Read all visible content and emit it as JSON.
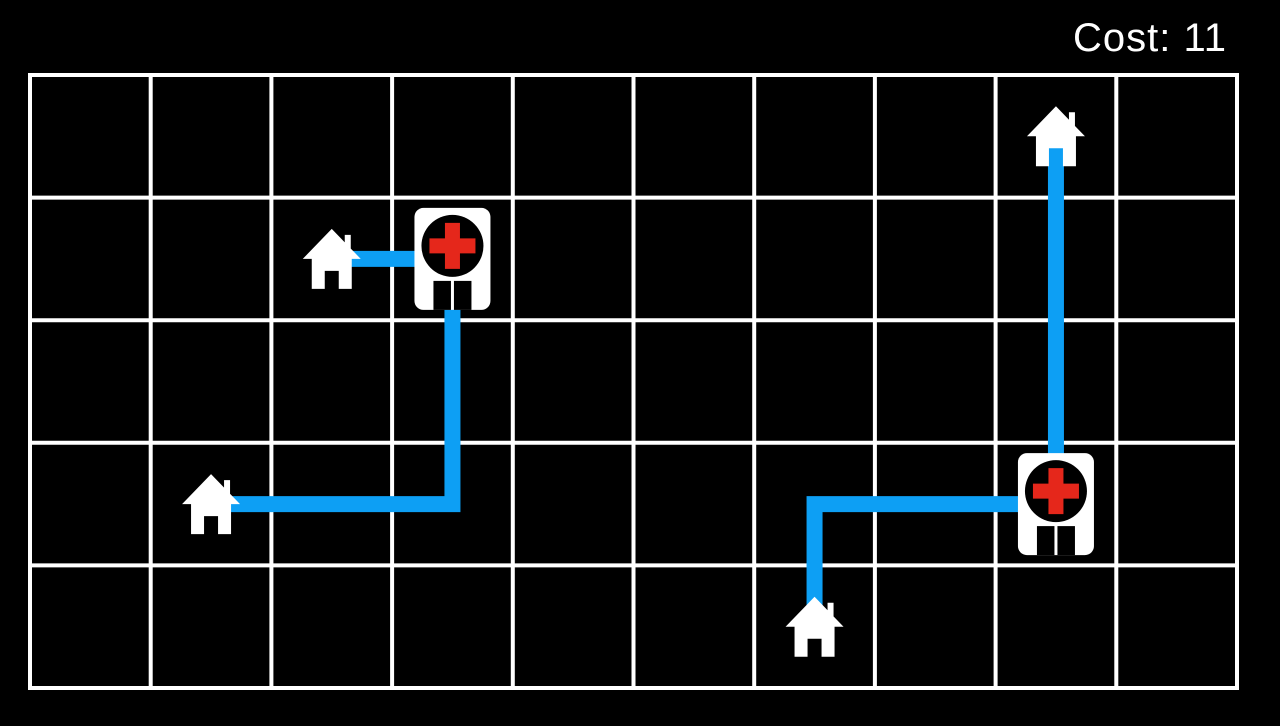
{
  "hud": {
    "cost_label": "Cost: 11",
    "cost_value": 11
  },
  "board": {
    "grid": {
      "columns": 10,
      "rows": 5,
      "left": 30,
      "top": 75,
      "cell_width": 120.7,
      "cell_height": 122.6,
      "line_thickness": 4
    },
    "entities": [
      {
        "id": "house-1",
        "type": "house",
        "row": 1,
        "col": 2
      },
      {
        "id": "hospital-1",
        "type": "hospital",
        "row": 1,
        "col": 3
      },
      {
        "id": "house-2",
        "type": "house",
        "row": 3,
        "col": 1
      },
      {
        "id": "house-3",
        "type": "house",
        "row": 0,
        "col": 8
      },
      {
        "id": "hospital-2",
        "type": "hospital",
        "row": 3,
        "col": 8
      },
      {
        "id": "house-4",
        "type": "house",
        "row": 4,
        "col": 6
      }
    ],
    "routes": [
      {
        "from": "house-1",
        "to": "hospital-1",
        "waypoints": [
          [
            1,
            2
          ],
          [
            1,
            3
          ]
        ]
      },
      {
        "from": "house-2",
        "to": "hospital-1",
        "waypoints": [
          [
            3,
            1
          ],
          [
            3,
            3
          ],
          [
            1,
            3
          ]
        ]
      },
      {
        "from": "house-3",
        "to": "hospital-2",
        "waypoints": [
          [
            0,
            8
          ],
          [
            3,
            8
          ]
        ]
      },
      {
        "from": "house-4",
        "to": "hospital-2",
        "waypoints": [
          [
            4,
            6
          ],
          [
            3,
            6
          ],
          [
            3,
            8
          ]
        ]
      }
    ],
    "route_thickness": 16
  },
  "colors": {
    "background": "#000000",
    "grid_line": "#ffffff",
    "route_blue": "#0d9ff4",
    "icon_white": "#ffffff",
    "cross_red": "#e5271b",
    "hud_text": "#ffffff"
  }
}
